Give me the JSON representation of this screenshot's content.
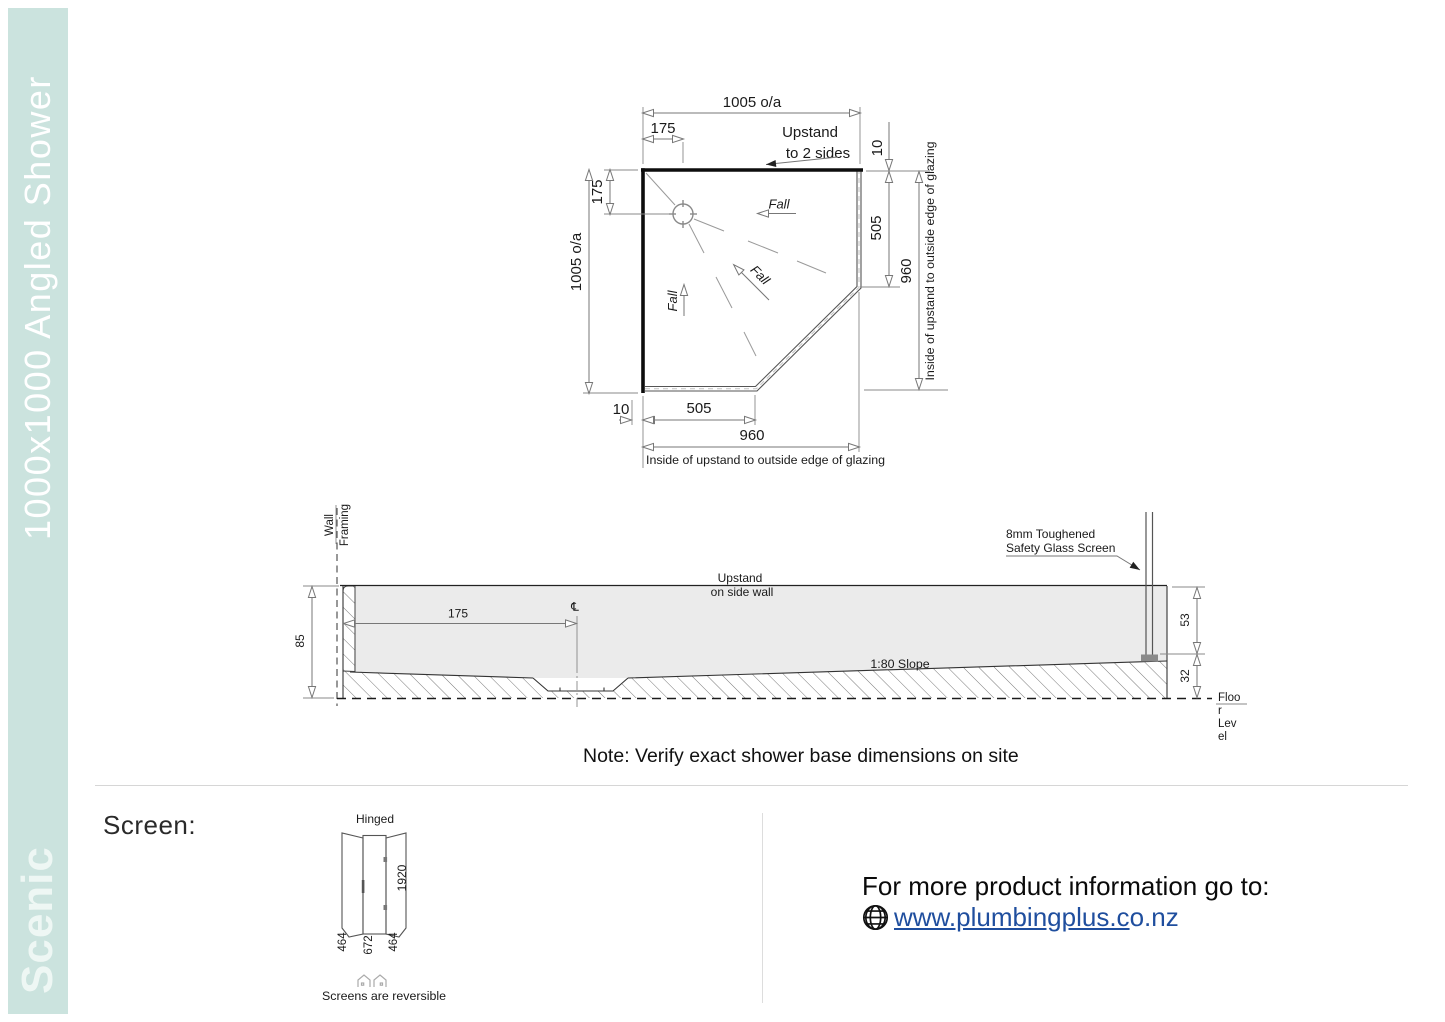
{
  "colors": {
    "sidebar": "#cbe3de",
    "link": "#1f4e9e",
    "gray": "#ebebeb"
  },
  "sidebar": {
    "title": "1000x1000 Angled Shower",
    "brand": "Scenic"
  },
  "plan": {
    "dim_top_overall": "1005 o/a",
    "dim_top_175": "175",
    "upstand_line1": "Upstand",
    "upstand_line2": "to 2 sides",
    "dim_right_10": "10",
    "dim_right_505": "505",
    "dim_right_960": "960",
    "caption_right": "Inside of upstand to outside edge of glazing",
    "dim_left_175": "175",
    "dim_left_overall": "1005 o/a",
    "dim_bottom_10": "10",
    "dim_bottom_505": "505",
    "dim_bottom_960": "960",
    "caption_bottom": "Inside of upstand to outside edge of glazing",
    "fall": "Fall"
  },
  "section": {
    "wall_line1": "Wall",
    "wall_line2": "Framing",
    "dim_85": "85",
    "dim_175": "175",
    "centerline": "℄",
    "upstand_line1": "Upstand",
    "upstand_line2": "on side wall",
    "glass_line1": "8mm Toughened",
    "glass_line2": "Safety Glass Screen",
    "slope": "1:80 Slope",
    "dim_53": "53",
    "dim_32": "32",
    "floor_lines": [
      "Floo",
      "r",
      "Lev",
      "el"
    ]
  },
  "note": "Note: Verify exact shower base dimensions on site",
  "screen": {
    "heading": "Screen:",
    "hinged": "Hinged",
    "dim_height": "1920",
    "dim_left": "464",
    "dim_mid": "672",
    "dim_right": "464",
    "reversible": "Screens are reversible"
  },
  "footer": {
    "info": "For more product information go to:",
    "link_main": "www.plumbingplus.c",
    "link_tail": "o.nz"
  }
}
